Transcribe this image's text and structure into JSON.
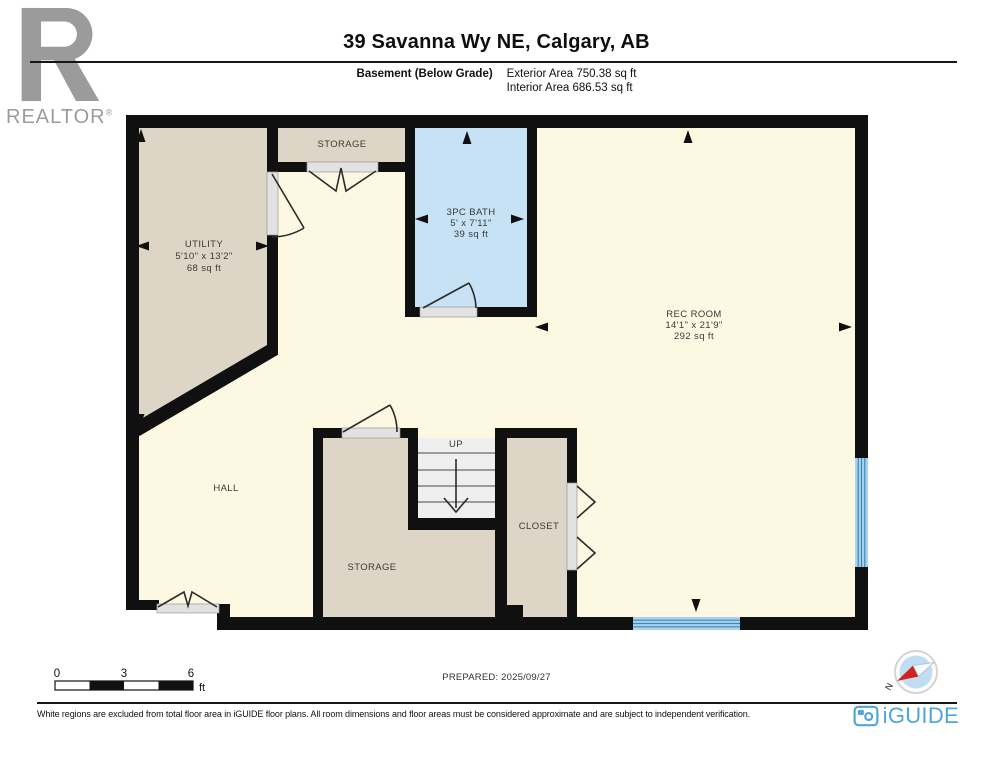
{
  "header": {
    "realtor": "REALTOR",
    "reg": "®",
    "title": "39 Savanna Wy NE, Calgary, AB",
    "floor": "Basement (Below Grade)",
    "exterior": "Exterior Area 750.38 sq ft",
    "interior": "Interior Area 686.53 sq ft"
  },
  "plan": {
    "rooms": {
      "utility": {
        "name": "UTILITY",
        "dims": "5'10\" x 13'2\"",
        "area": "68 sq ft"
      },
      "storage_top": {
        "name": "STORAGE"
      },
      "bath": {
        "name": "3PC BATH",
        "dims": "5' x 7'11\"",
        "area": "39 sq ft"
      },
      "rec": {
        "name": "REC ROOM",
        "dims": "14'1\" x 21'9\"",
        "area": "292 sq ft"
      },
      "hall": {
        "name": "HALL"
      },
      "storage_bottom": {
        "name": "STORAGE"
      },
      "closet": {
        "name": "CLOSET"
      }
    },
    "stairs": {
      "label": "UP"
    }
  },
  "scalebar": {
    "t0": "0",
    "t1": "3",
    "t2": "6",
    "unit": "ft"
  },
  "prepared": "PREPARED: 2025/09/27",
  "compass": {
    "north": "N"
  },
  "footer": {
    "disclaimer": "White regions are excluded from total floor area in iGUIDE floor plans. All room dimensions and floor areas must be considered approximate and are subject to independent verification.",
    "brand": "iGUIDE"
  },
  "colors": {
    "room_fill": "#ddd6c6",
    "hall_fill": "#fcf8e2",
    "bath_fill": "#c6e2f4",
    "stairs_fill": "#efefef",
    "window_fill": "#a9d3ee",
    "wall": "#101010",
    "brand_blue": "#4fa6d8",
    "compass_red": "#d42020",
    "logo_gray": "#9b9b9b"
  }
}
